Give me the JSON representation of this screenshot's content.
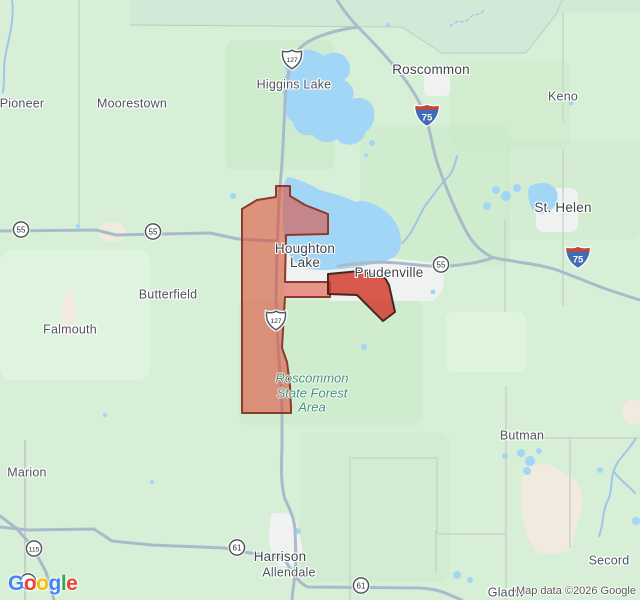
{
  "map": {
    "attribution": "Map data ©2026 Google",
    "colors": {
      "land": "#d7efd6",
      "land_dark": "#cbe9ca",
      "land_light": "#e3f6e1",
      "land_gray": "#d3e9d8",
      "water": "#a2d6f7",
      "water_line": "#9fc6e8",
      "urban": "#f0f2f1",
      "beige": "#f1ebdf",
      "road": "#a9bbcb",
      "road_minor": "#c6cfca",
      "boundary": "#c0cac3",
      "town_label": "#4d545a",
      "city_label": "#3f454b",
      "forest_label": "#3f9178",
      "attribution_label": "#555555",
      "region_fill": "rgba(226,66,48,0.54)",
      "region_stroke": "#8a3a2e",
      "region2_fill": "rgba(210,55,40,0.82)",
      "region2_stroke": "#45281f"
    },
    "regions": [
      {
        "id": "houghton-lake-region",
        "label": "Houghton Lake highlighted boundary"
      },
      {
        "id": "prudenville-region",
        "label": "Prudenville highlighted boundary"
      }
    ],
    "towns": [
      {
        "text": "Pioneer",
        "x": 22,
        "y": 104,
        "kind": "village"
      },
      {
        "text": "Moorestown",
        "x": 132,
        "y": 104,
        "kind": "village"
      },
      {
        "text": "Higgins Lake",
        "x": 294,
        "y": 85,
        "kind": "village"
      },
      {
        "text": "Roscommon",
        "x": 431,
        "y": 70,
        "kind": "city"
      },
      {
        "text": "Keno",
        "x": 563,
        "y": 97,
        "kind": "village"
      },
      {
        "text": "St. Helen",
        "x": 563,
        "y": 208,
        "kind": "city"
      },
      {
        "text": "Houghton\nLake",
        "x": 305,
        "y": 256,
        "kind": "city"
      },
      {
        "text": "Prudenville",
        "x": 389,
        "y": 273,
        "kind": "city"
      },
      {
        "text": "Butterfield",
        "x": 168,
        "y": 295,
        "kind": "village"
      },
      {
        "text": "Falmouth",
        "x": 70,
        "y": 330,
        "kind": "village"
      },
      {
        "text": "Butman",
        "x": 522,
        "y": 436,
        "kind": "village"
      },
      {
        "text": "Marion",
        "x": 27,
        "y": 473,
        "kind": "village"
      },
      {
        "text": "Harrison",
        "x": 280,
        "y": 557,
        "kind": "city"
      },
      {
        "text": "Allendale",
        "x": 289,
        "y": 573,
        "kind": "village"
      },
      {
        "text": "Secord",
        "x": 609,
        "y": 561,
        "kind": "village"
      },
      {
        "text": "Gladw",
        "x": 506,
        "y": 593,
        "kind": "village"
      }
    ],
    "forest": {
      "text": "Roscommon\nState Forest\nArea",
      "x": 312,
      "y": 393
    },
    "shields": [
      {
        "type": "us",
        "num": "127",
        "x": 292,
        "y": 62
      },
      {
        "type": "us",
        "num": "127",
        "x": 276,
        "y": 323
      },
      {
        "type": "interstate",
        "num": "75",
        "x": 427,
        "y": 118
      },
      {
        "type": "interstate",
        "num": "75",
        "x": 578,
        "y": 260
      },
      {
        "type": "circle",
        "num": "55",
        "x": 21,
        "y": 232
      },
      {
        "type": "circle",
        "num": "55",
        "x": 153,
        "y": 234
      },
      {
        "type": "circle",
        "num": "55",
        "x": 441,
        "y": 267
      },
      {
        "type": "circle",
        "num": "115",
        "x": 34,
        "y": 551
      },
      {
        "type": "circle",
        "num": "61",
        "x": 237,
        "y": 550
      },
      {
        "type": "circle",
        "num": "61",
        "x": 361,
        "y": 588
      },
      {
        "type": "circle",
        "num": "",
        "x": 28,
        "y": 584
      }
    ],
    "logo": {
      "letters": [
        {
          "ch": "G",
          "color": "#4285F4"
        },
        {
          "ch": "o",
          "color": "#EA4335"
        },
        {
          "ch": "o",
          "color": "#FBBC05"
        },
        {
          "ch": "g",
          "color": "#4285F4"
        },
        {
          "ch": "l",
          "color": "#34A853"
        },
        {
          "ch": "e",
          "color": "#EA4335"
        }
      ]
    }
  }
}
